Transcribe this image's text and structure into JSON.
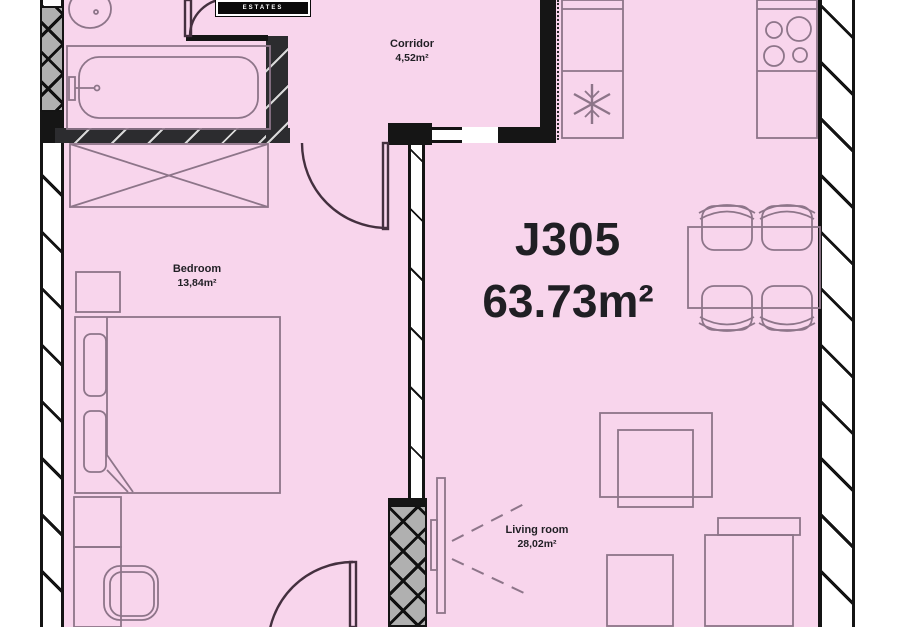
{
  "unit": {
    "id": "J305",
    "area": "63.73m²"
  },
  "logo": {
    "text": "ESTATES"
  },
  "rooms": {
    "corridor": {
      "name": "Corridor",
      "area": "4,52m²"
    },
    "bedroom": {
      "name": "Bedroom",
      "area": "13,84m²"
    },
    "living": {
      "name": "Living room",
      "area": "28,02m²"
    }
  },
  "colors": {
    "floor": "#f8d5ec",
    "wall": "#151515",
    "wall_gray": "#b0b0b0",
    "furniture": "#8d7589",
    "door": "#44303f",
    "text": "#201f24"
  }
}
